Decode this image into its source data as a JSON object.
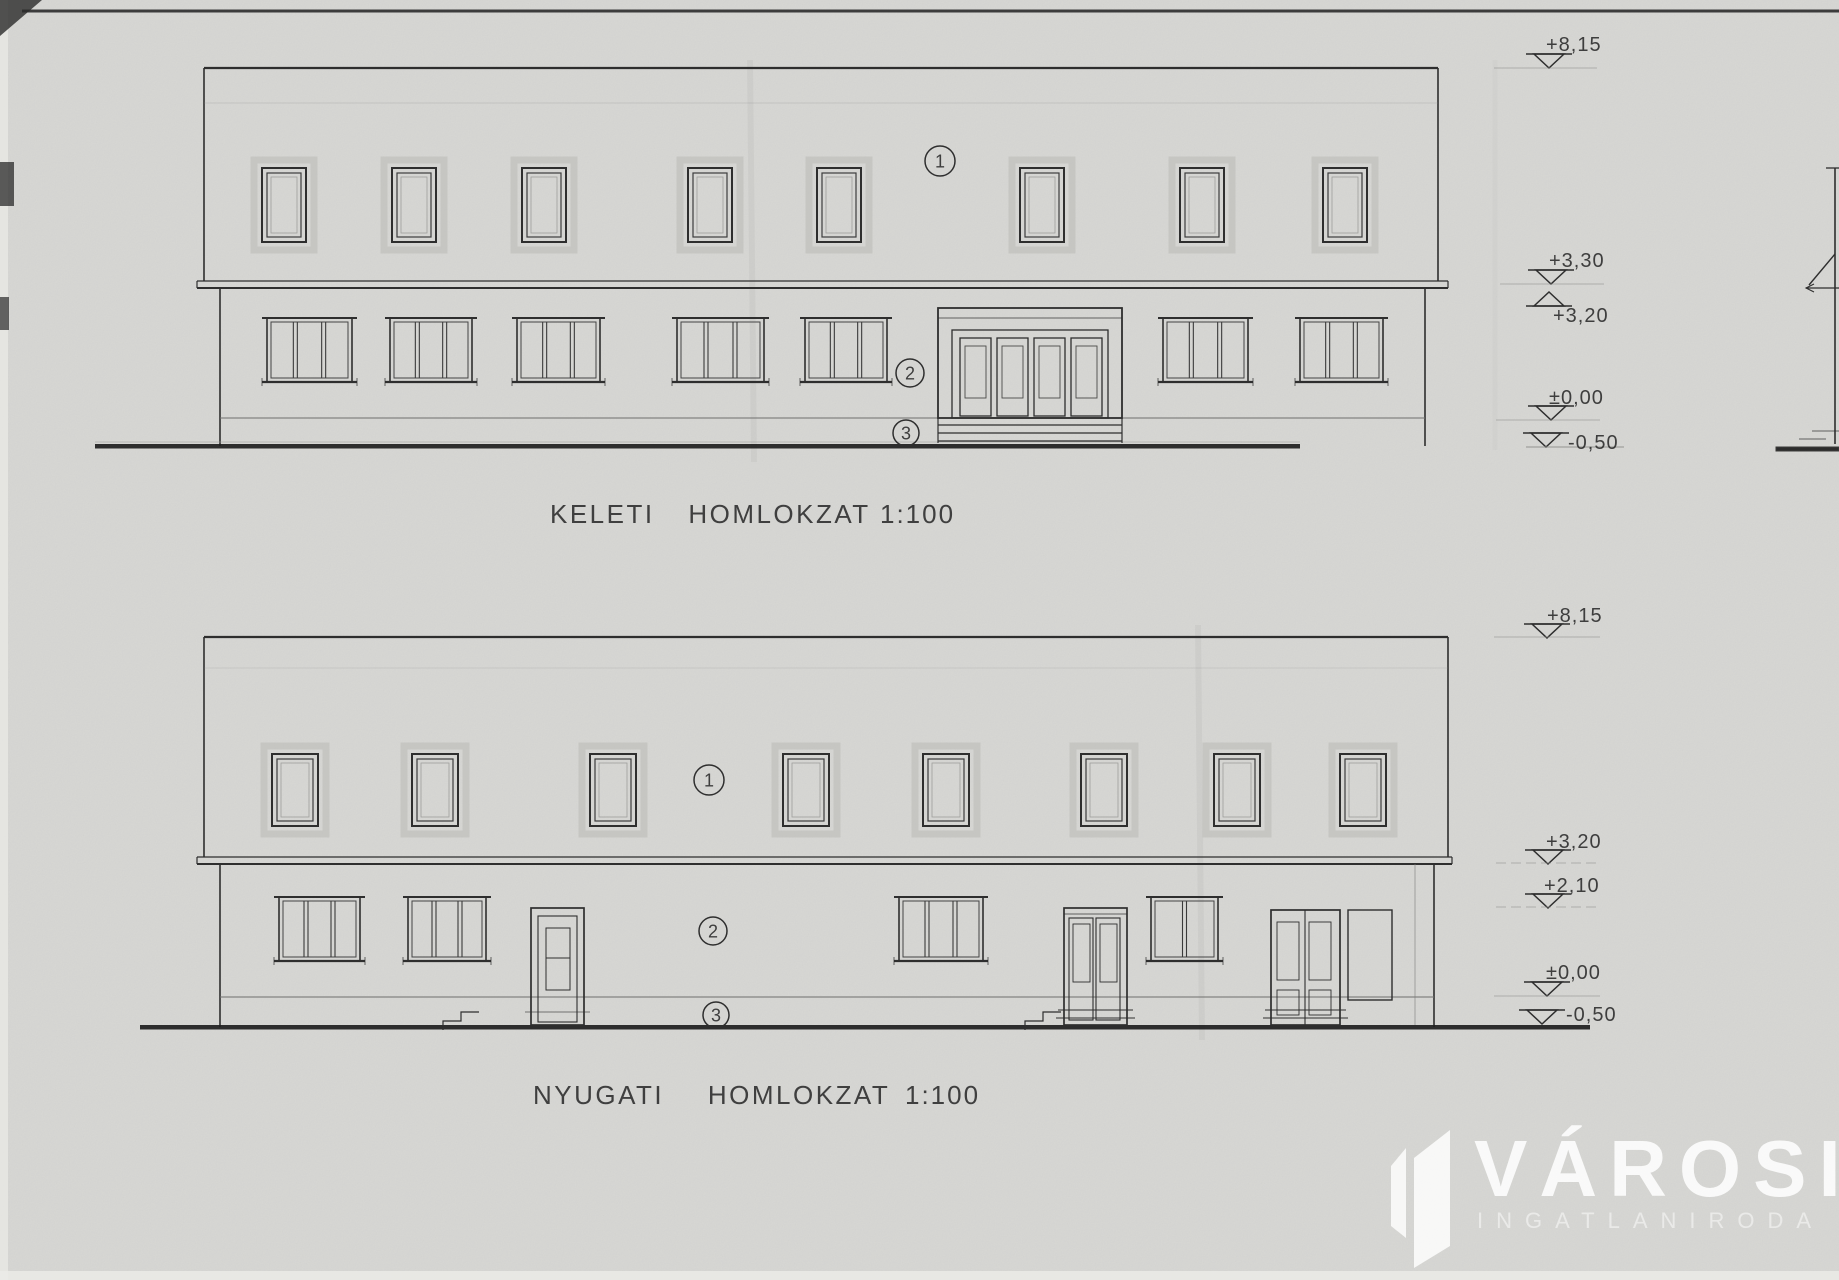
{
  "elevations": {
    "top": {
      "title": "KELETI HOMLOKZAT",
      "scale": "1:100",
      "levels": [
        "+8,15",
        "+3,30",
        "+3,20",
        "±0,00",
        "-0,50"
      ],
      "tags": [
        "1",
        "2",
        "3"
      ]
    },
    "bottom": {
      "title": "NYUGATI HOMLOKZAT",
      "scale": "1:100",
      "levels": [
        "+8,15",
        "+3,20",
        "+2,10",
        "±0,00",
        "-0,50"
      ],
      "tags": [
        "1",
        "2",
        "3"
      ]
    }
  },
  "watermark": {
    "brand": "VÁROSI",
    "subtitle": "INGATLANIRODA"
  },
  "colors": {
    "paper": "#d6d6d3",
    "ink": "#2e2e2e",
    "ground": "#1e1e1e",
    "watermark": "#ffffff"
  }
}
